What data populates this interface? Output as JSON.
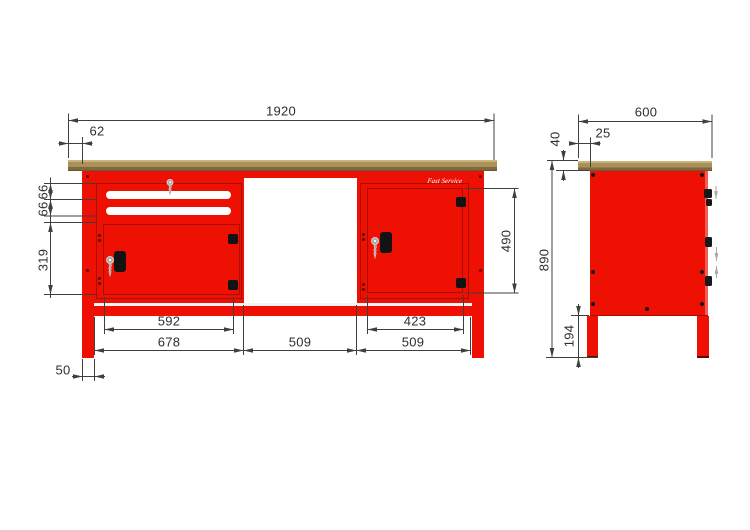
{
  "colors": {
    "cabinet_red": "#ee1103",
    "cabinet_red_dark": "#a60f03",
    "worktop_tan": "#ab9057",
    "worktop_light": "#c9b47e",
    "worktop_dark": "#7e6a41",
    "dimension_line": "#3f3f3f",
    "key_gray": "#a9a9a9",
    "handle_black": "#131313"
  },
  "logo": {
    "text": "Fast Service"
  },
  "front_view": {
    "dims": {
      "total_width": "1920",
      "worktop_overhang": "62",
      "drawer_1_height": "66",
      "drawer_2_height": "66",
      "left_door_height": "319",
      "right_door_height": "490",
      "left_door_width": "592",
      "left_cabinet_width": "678",
      "center_opening_width": "509",
      "right_cabinet_width": "509",
      "right_door_width": "423",
      "leg_width": "50"
    }
  },
  "side_view": {
    "dims": {
      "depth": "600",
      "worktop_overhang": "25",
      "worktop_thickness": "40",
      "total_height": "890",
      "leg_height": "194"
    }
  }
}
